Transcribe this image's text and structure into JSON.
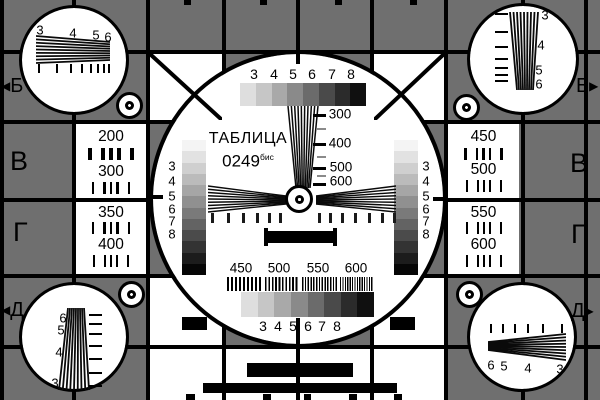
{
  "colors": {
    "background": "#6f6f6f",
    "grid_line": "#000000",
    "card_white": "#ffffff",
    "ink": "#000000"
  },
  "title": {
    "name": "ТАБЛИЦА",
    "number": "0249",
    "suffix": "бис"
  },
  "row_markers": {
    "top_left": {
      "arrow": "◀",
      "letter": "Б"
    },
    "top_right": {
      "letter": "Б",
      "arrow": "▶"
    },
    "mid_left": "В",
    "mid_right": "В",
    "lower_left": "Г",
    "lower_right": "Г",
    "bottom_left": {
      "arrow": "◀",
      "letter": "Д"
    },
    "bottom_right": {
      "letter": "Д",
      "arrow": "▶"
    }
  },
  "labels": {
    "grayscale_top": [
      "3",
      "4",
      "5",
      "6",
      "7",
      "8"
    ],
    "grayscale_bottom": [
      "3",
      "4",
      "5",
      "6",
      "7",
      "8"
    ],
    "strip_left": [
      "3",
      "4",
      "5",
      "6",
      "7",
      "8"
    ],
    "strip_right": [
      "3",
      "4",
      "5",
      "6",
      "7",
      "8"
    ],
    "center_wedge": [
      "300",
      "400",
      "500",
      "600"
    ],
    "burst": [
      "450",
      "500",
      "550",
      "600"
    ],
    "corner_top_left": [
      "3",
      "4",
      "5",
      "6"
    ],
    "corner_top_right": [
      "3",
      "4",
      "5",
      "6"
    ],
    "corner_bottom_left": [
      "6",
      "5",
      "4",
      "3"
    ],
    "corner_bottom_right": [
      "6",
      "5",
      "4",
      "3"
    ]
  },
  "side_numbers": {
    "left_top": [
      "200",
      "300"
    ],
    "left_bottom": [
      "350",
      "400"
    ],
    "right_top": [
      "450",
      "500"
    ],
    "right_bottom": [
      "550",
      "600"
    ]
  },
  "grayscale_steps": [
    "#dedede",
    "#c6c6c6",
    "#a9a9a9",
    "#8a8a8a",
    "#6b6b6b",
    "#4a4a4a",
    "#2b2b2b",
    "#101010"
  ],
  "strip_steps": [
    "#f4f4f4",
    "#e2e2e2",
    "#cfcfcf",
    "#bbbbbb",
    "#a6a6a6",
    "#909090",
    "#7a7a7a",
    "#636363",
    "#4b4b4b",
    "#333333",
    "#1c1c1c",
    "#060606"
  ]
}
